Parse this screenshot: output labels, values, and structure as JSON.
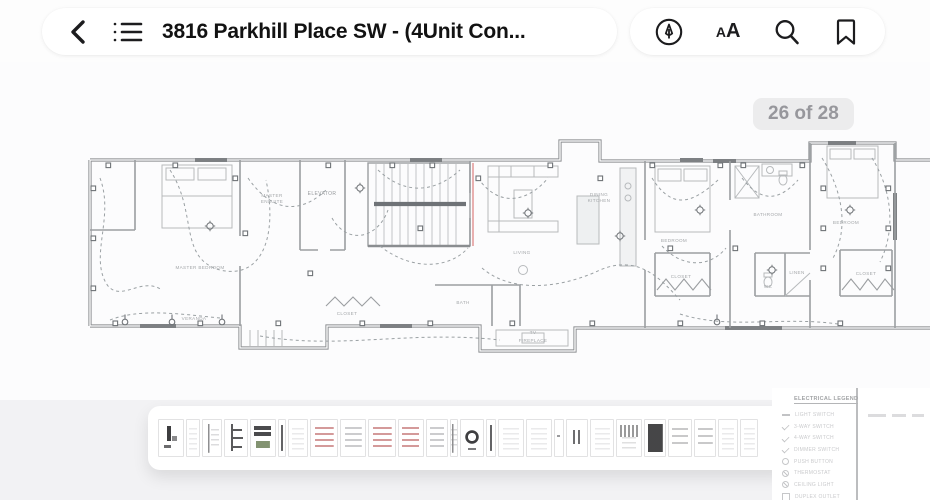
{
  "toolbar": {
    "title": "3816 Parkhill Place SW - (4Unit Con...",
    "back_label": "back",
    "contents_label": "table of contents",
    "appearance_glyph_small": "A",
    "appearance_glyph_large": "A"
  },
  "page_indicator": "26 of 28",
  "floorplan": {
    "accent_red": "#e4a3a3",
    "wall_color": "#8a8d90",
    "labels": [
      {
        "t": "MASTER BEDROOM",
        "x": 120,
        "y": 151,
        "c": "plan-label"
      },
      {
        "t": "MASTER",
        "x": 192,
        "y": 79,
        "c": "plan-label"
      },
      {
        "t": "ENSUITE",
        "x": 192,
        "y": 85,
        "c": "plan-label"
      },
      {
        "t": "ELEVATOR",
        "x": 242,
        "y": 77,
        "c": "plan-label dk"
      },
      {
        "t": "LIVING",
        "x": 442,
        "y": 136,
        "c": "plan-label"
      },
      {
        "t": "DINING",
        "x": 519,
        "y": 78,
        "c": "plan-label"
      },
      {
        "t": "KITCHEN",
        "x": 519,
        "y": 84,
        "c": "plan-label"
      },
      {
        "t": "BEDROOM",
        "x": 594,
        "y": 124,
        "c": "plan-label"
      },
      {
        "t": "BATHROOM",
        "x": 688,
        "y": 98,
        "c": "plan-label"
      },
      {
        "t": "BEDROOM",
        "x": 766,
        "y": 106,
        "c": "plan-label"
      },
      {
        "t": "CLOSET",
        "x": 601,
        "y": 160,
        "c": "plan-label"
      },
      {
        "t": "CLOSET",
        "x": 786,
        "y": 157,
        "c": "plan-label"
      },
      {
        "t": "CLOSET",
        "x": 267,
        "y": 197,
        "c": "plan-label"
      },
      {
        "t": "WC",
        "x": 688,
        "y": 170,
        "c": "plan-label"
      },
      {
        "t": "LINEN",
        "x": 717,
        "y": 156,
        "c": "plan-label"
      },
      {
        "t": "BATH",
        "x": 383,
        "y": 186,
        "c": "plan-label"
      },
      {
        "t": "VERANDA",
        "x": 114,
        "y": 202,
        "c": "plan-label"
      },
      {
        "t": "TV",
        "x": 453,
        "y": 216,
        "c": "plan-label"
      },
      {
        "t": "FIREPLACE",
        "x": 453,
        "y": 224,
        "c": "plan-label"
      }
    ]
  },
  "filmstrip": {
    "cells": [
      {
        "style": "glyph",
        "w": 26
      },
      {
        "style": "faint",
        "w": 14
      },
      {
        "style": "line",
        "w": 20
      },
      {
        "style": "bracket",
        "w": 24
      },
      {
        "style": "bars",
        "w": 26
      },
      {
        "style": "thin",
        "w": 8
      },
      {
        "style": "faint",
        "w": 20
      },
      {
        "style": "red",
        "w": 28
      },
      {
        "style": "gray",
        "w": 26
      },
      {
        "style": "red",
        "w": 28
      },
      {
        "style": "red",
        "w": 26
      },
      {
        "style": "gray",
        "w": 22
      },
      {
        "style": "line",
        "w": 8
      },
      {
        "style": "circle",
        "w": 24
      },
      {
        "style": "thin",
        "w": 10
      },
      {
        "style": "faint",
        "w": 26
      },
      {
        "style": "faint",
        "w": 26
      },
      {
        "style": "dash",
        "w": 10
      },
      {
        "style": "marks",
        "w": 22
      },
      {
        "style": "faint",
        "w": 24
      },
      {
        "style": "scribble",
        "w": 26
      },
      {
        "style": "dark",
        "w": 22
      },
      {
        "style": "text",
        "w": 24
      },
      {
        "style": "text",
        "w": 22
      },
      {
        "style": "faint",
        "w": 20
      },
      {
        "style": "faint",
        "w": 18
      }
    ]
  },
  "legend": {
    "title": "ELECTRICAL LEGEND",
    "items": [
      {
        "symbol": "dash",
        "label": "LIGHT SWITCH"
      },
      {
        "symbol": "check",
        "label": "3-WAY SWITCH"
      },
      {
        "symbol": "check",
        "label": "4-WAY SWITCH"
      },
      {
        "symbol": "check",
        "label": "DIMMER SWITCH"
      },
      {
        "symbol": "circle",
        "label": "PUSH BUTTON"
      },
      {
        "symbol": "circle-slash",
        "label": "THERMOSTAT"
      },
      {
        "symbol": "circle-slash",
        "label": "CEILING LIGHT"
      },
      {
        "symbol": "square",
        "label": "DUPLEX OUTLET"
      }
    ]
  }
}
